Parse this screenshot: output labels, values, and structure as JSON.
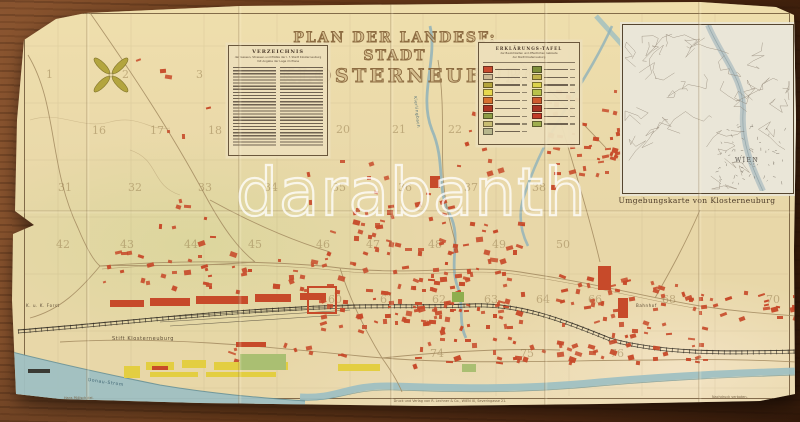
{
  "scene": {
    "watermark": "darabanth"
  },
  "map": {
    "title_line1": "PLAN DER LANDESF: STADT",
    "title_line2": "KLOSTERNEUBURG",
    "imprint": "Druck und Verlag von R. Lechner & Co., WIEN IX, Severingasse 21.",
    "credit_left": "Hans Pöllisch del.",
    "credit_right": "Nachdruck verboten.",
    "index_box": {
      "heading": "VERZEICHNIS",
      "subtitle1": "der Gassen, Strassen und Plätze der l. f. Stadt Klosterneuburg",
      "subtitle2": "mit Angabe der Lage im Plane"
    },
    "legend_box": {
      "heading": "ERKLÄRUNGS-TAFEL",
      "subtitle1": "der Baulichkeiten und öffentlichen Gebäude",
      "subtitle2": "der Stadt Klosterneuburg",
      "left_swatches": [
        "#c84a2e",
        "#cbb893",
        "#b4a43c",
        "#e7d84e",
        "#d8702f",
        "#ab3522",
        "#8d9d44",
        "#c9bd72",
        "#b7b68c"
      ],
      "right_swatches": [
        "#7f8f3a",
        "#c2b34c",
        "#dcd24d",
        "#b9c24a",
        "#cf5a2d",
        "#a63322",
        "#c23b28",
        "#9fae4e"
      ]
    },
    "inset": {
      "caption": "Umgebungskarte von Klosterneuburg",
      "city_label": "WIEN"
    },
    "labels": [
      {
        "text": "Stift Klosterneuburg",
        "x": 112,
        "y": 336,
        "size": 5,
        "rot": 0,
        "color": "#5a4a34"
      },
      {
        "text": "K. u. K. Forst",
        "x": 26,
        "y": 303,
        "size": 4,
        "rot": 0,
        "color": "#5a4a34"
      },
      {
        "text": "Donau-Strom",
        "x": 88,
        "y": 378,
        "size": 4.5,
        "rot": 8,
        "color": "#3e6472"
      },
      {
        "text": "Bahnhof",
        "x": 636,
        "y": 303,
        "size": 4,
        "rot": 0,
        "color": "#5a4a34"
      },
      {
        "text": "Kierlingbach",
        "x": 418,
        "y": 96,
        "size": 4,
        "rot": 84,
        "color": "#4a6b76"
      }
    ],
    "grid_numbers": [
      {
        "n": "1",
        "x": 46,
        "y": 68
      },
      {
        "n": "2",
        "x": 122,
        "y": 68
      },
      {
        "n": "3",
        "x": 196,
        "y": 68
      },
      {
        "n": "16",
        "x": 92,
        "y": 124
      },
      {
        "n": "17",
        "x": 150,
        "y": 124
      },
      {
        "n": "18",
        "x": 208,
        "y": 124
      },
      {
        "n": "20",
        "x": 336,
        "y": 123
      },
      {
        "n": "21",
        "x": 392,
        "y": 123
      },
      {
        "n": "22",
        "x": 448,
        "y": 123
      },
      {
        "n": "31",
        "x": 58,
        "y": 181
      },
      {
        "n": "32",
        "x": 128,
        "y": 181
      },
      {
        "n": "33",
        "x": 198,
        "y": 181
      },
      {
        "n": "34",
        "x": 264,
        "y": 181
      },
      {
        "n": "35",
        "x": 332,
        "y": 181
      },
      {
        "n": "36",
        "x": 398,
        "y": 181
      },
      {
        "n": "37",
        "x": 464,
        "y": 181
      },
      {
        "n": "38",
        "x": 532,
        "y": 181
      },
      {
        "n": "42",
        "x": 56,
        "y": 238
      },
      {
        "n": "43",
        "x": 120,
        "y": 238
      },
      {
        "n": "44",
        "x": 184,
        "y": 238
      },
      {
        "n": "45",
        "x": 248,
        "y": 238
      },
      {
        "n": "46",
        "x": 316,
        "y": 238
      },
      {
        "n": "47",
        "x": 366,
        "y": 238
      },
      {
        "n": "48",
        "x": 428,
        "y": 238
      },
      {
        "n": "49",
        "x": 492,
        "y": 238
      },
      {
        "n": "50",
        "x": 556,
        "y": 238
      },
      {
        "n": "60",
        "x": 328,
        "y": 293
      },
      {
        "n": "61",
        "x": 380,
        "y": 293
      },
      {
        "n": "62",
        "x": 432,
        "y": 293
      },
      {
        "n": "63",
        "x": 484,
        "y": 293
      },
      {
        "n": "64",
        "x": 536,
        "y": 293
      },
      {
        "n": "66",
        "x": 588,
        "y": 293
      },
      {
        "n": "68",
        "x": 662,
        "y": 293
      },
      {
        "n": "70",
        "x": 766,
        "y": 293
      },
      {
        "n": "74",
        "x": 430,
        "y": 347
      },
      {
        "n": "75",
        "x": 520,
        "y": 347
      },
      {
        "n": "76",
        "x": 610,
        "y": 347
      }
    ],
    "building_clusters": [
      {
        "x": 540,
        "y": 85,
        "w": 88,
        "h": 100,
        "n": 38
      },
      {
        "x": 300,
        "y": 152,
        "w": 130,
        "h": 55,
        "n": 8
      },
      {
        "x": 318,
        "y": 220,
        "w": 205,
        "h": 112,
        "n": 130
      },
      {
        "x": 98,
        "y": 250,
        "w": 218,
        "h": 40,
        "n": 40
      },
      {
        "x": 118,
        "y": 52,
        "w": 110,
        "h": 82,
        "n": 6
      },
      {
        "x": 552,
        "y": 274,
        "w": 152,
        "h": 88,
        "n": 80
      },
      {
        "x": 698,
        "y": 290,
        "w": 96,
        "h": 30,
        "n": 20
      },
      {
        "x": 412,
        "y": 336,
        "w": 132,
        "h": 38,
        "n": 22
      },
      {
        "x": 128,
        "y": 196,
        "w": 88,
        "h": 46,
        "n": 8
      },
      {
        "x": 586,
        "y": 90,
        "w": 34,
        "h": 72,
        "n": 9
      },
      {
        "x": 224,
        "y": 340,
        "w": 118,
        "h": 20,
        "n": 10
      },
      {
        "x": 452,
        "y": 112,
        "w": 72,
        "h": 62,
        "n": 8
      },
      {
        "x": 342,
        "y": 198,
        "w": 122,
        "h": 26,
        "n": 12
      },
      {
        "x": 360,
        "y": 300,
        "w": 140,
        "h": 30,
        "n": 25
      }
    ],
    "structures": [
      {
        "x": 110,
        "y": 300,
        "w": 34,
        "h": 7,
        "c": "bldg"
      },
      {
        "x": 150,
        "y": 298,
        "w": 40,
        "h": 8,
        "c": "bldg"
      },
      {
        "x": 196,
        "y": 296,
        "w": 52,
        "h": 8,
        "c": "bldg"
      },
      {
        "x": 255,
        "y": 294,
        "w": 36,
        "h": 8,
        "c": "bldg"
      },
      {
        "x": 300,
        "y": 293,
        "w": 26,
        "h": 7,
        "c": "bldg"
      },
      {
        "x": 307,
        "y": 286,
        "w": 26,
        "h": 24,
        "c": "bldg",
        "hollow": true
      },
      {
        "x": 236,
        "y": 342,
        "w": 30,
        "h": 5,
        "c": "bldg"
      },
      {
        "x": 124,
        "y": 366,
        "w": 16,
        "h": 12,
        "c": "yellow"
      },
      {
        "x": 146,
        "y": 362,
        "w": 28,
        "h": 8,
        "c": "yellow"
      },
      {
        "x": 150,
        "y": 372,
        "w": 48,
        "h": 5,
        "c": "yellow"
      },
      {
        "x": 182,
        "y": 360,
        "w": 24,
        "h": 8,
        "c": "yellow"
      },
      {
        "x": 214,
        "y": 362,
        "w": 40,
        "h": 8,
        "c": "yellow"
      },
      {
        "x": 258,
        "y": 362,
        "w": 30,
        "h": 8,
        "c": "yellow"
      },
      {
        "x": 206,
        "y": 372,
        "w": 70,
        "h": 5,
        "c": "yellow"
      },
      {
        "x": 338,
        "y": 364,
        "w": 42,
        "h": 7,
        "c": "yellow"
      },
      {
        "x": 152,
        "y": 366,
        "w": 16,
        "h": 4,
        "c": "bldg"
      },
      {
        "x": 240,
        "y": 354,
        "w": 46,
        "h": 16,
        "c": "green"
      },
      {
        "x": 452,
        "y": 292,
        "w": 12,
        "h": 10,
        "c": "green2"
      },
      {
        "x": 462,
        "y": 364,
        "w": 14,
        "h": 8,
        "c": "green"
      },
      {
        "x": 598,
        "y": 266,
        "w": 13,
        "h": 24,
        "c": "bldg"
      },
      {
        "x": 618,
        "y": 298,
        "w": 10,
        "h": 20,
        "c": "bldg"
      },
      {
        "x": 430,
        "y": 176,
        "w": 10,
        "h": 12,
        "c": "bldg"
      },
      {
        "x": 28,
        "y": 369,
        "w": 22,
        "h": 4,
        "c": "dark"
      }
    ],
    "colors": {
      "bldg": "#c74a2a",
      "yellow": "#e3ce41",
      "green": "#aabf72",
      "green2": "#8fae4e",
      "dark": "#3a3a34",
      "water": "#9fc0c2",
      "stream": "#8fb2ba",
      "paper": "#e8d7a8",
      "title_ink": "#8d6c42"
    }
  }
}
